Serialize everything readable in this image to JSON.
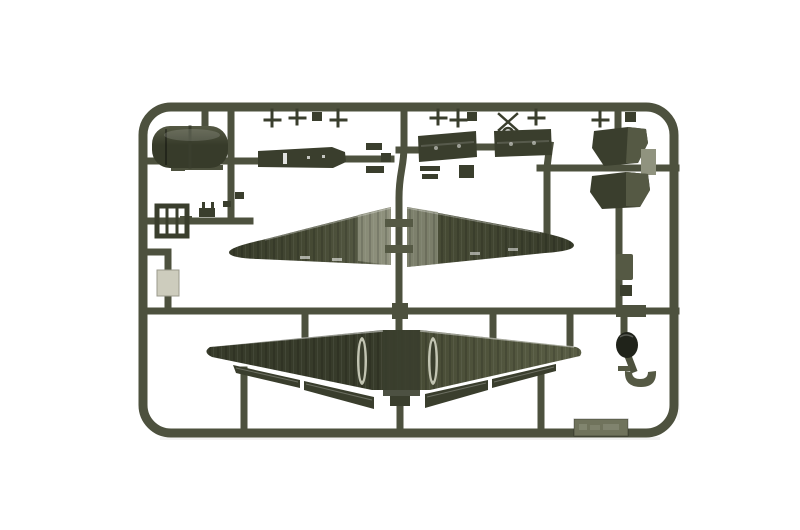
{
  "scene": {
    "title": "Model kit sprue photograph",
    "description": "Photograph of an olive-drab injection-molded plastic model kit sprue on a white background, holding aircraft parts: two upper wing halves, a one-piece corrugated lower wing with separated flaps and ailerons, an engine cowling, a cabin floor, two cargo doors, two bulkhead pieces, a window frame, a clear-grey insert, a wheel disc, a cowl ring and assorted small fittings. A small embossed identification tab is molded to the bottom rail; its stamped text is too small to read."
  },
  "label_tab": {
    "embossed_text_legible": false
  },
  "parts": [
    {
      "id": "engine-cowling-part",
      "description": "rounded cowling / nose piece, top left"
    },
    {
      "id": "cabin-floor-part",
      "description": "long tapered floor panel with slot openings"
    },
    {
      "id": "cargo-door-part-left",
      "description": "corrugated rectangular door panel"
    },
    {
      "id": "cargo-door-part-right",
      "description": "corrugated rectangular door panel"
    },
    {
      "id": "bulkhead-part-upper",
      "description": "angular bulkhead plate with light flange, right side"
    },
    {
      "id": "bulkhead-part-lower",
      "description": "mirrored angular bulkhead plate, right side"
    },
    {
      "id": "window-frame-part",
      "description": "small square frame with inner bars, left side"
    },
    {
      "id": "clear-insert-part",
      "description": "small light grey rectangular insert, left side"
    },
    {
      "id": "upper-wing-left-part",
      "description": "tapered upper wing half, root facing centre, grey sheen at root"
    },
    {
      "id": "upper-wing-right-part",
      "description": "tapered upper wing half, mirrored"
    },
    {
      "id": "lower-wing-part",
      "description": "full-span corrugated lower wing with nacelle slots"
    },
    {
      "id": "flap-strips",
      "description": "separated flap and aileron strips along wing trailing edge"
    },
    {
      "id": "small-box-part",
      "description": "small rectangular block on right runner"
    },
    {
      "id": "wheel-disc-part",
      "description": "dark round disc, right side"
    },
    {
      "id": "cowl-ring-part",
      "description": "half-ring cup piece, lower right"
    },
    {
      "id": "small-fittings",
      "description": "row of small T-shaped and square fittings along top rail"
    },
    {
      "id": "embossed-label-tab",
      "description": "molded label tab on bottom rail, text illegible"
    }
  ],
  "colors": {
    "background": "#ffffff",
    "sprue": "#4d513e",
    "part_dark": "#3a3e2d",
    "part_mid": "#555944",
    "sheen": "#90937f",
    "sheen_bright": "#c2c4b2",
    "wing_dark": "#373b2a",
    "wing_olive": "#474b35",
    "wing_olive_light": "#5a5e45",
    "clear_part": "#cdccbd",
    "tab": "#70735c",
    "disc_dark": "#20231a",
    "photo_shadow": "rgba(0,0,0,0.05)"
  }
}
